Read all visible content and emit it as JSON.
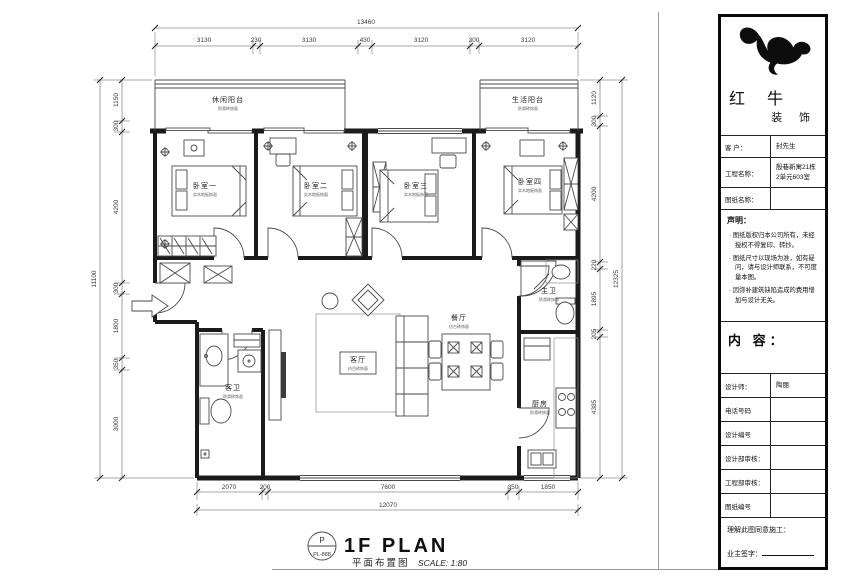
{
  "sheet": {
    "plan_title": {
      "badge_top": "P",
      "badge_bottom": "PL-888",
      "title": "1F PLAN",
      "subtitle": "平面布置图",
      "scale": "SCALE: 1:80"
    },
    "dimensions": {
      "top": {
        "total": "13460",
        "segments": [
          "3130",
          "230",
          "3130",
          "430",
          "3120",
          "300",
          "3120"
        ]
      },
      "left": {
        "total": "11100",
        "segments": [
          "1150",
          "300",
          "4200",
          "300",
          "1800",
          "350",
          "3000"
        ]
      },
      "right": {
        "total": "12325",
        "segments": [
          "1120",
          "300",
          "4200",
          "220",
          "1895",
          "205",
          "4385"
        ]
      },
      "bottom": {
        "total": "12070",
        "segments": [
          "2070",
          "200",
          "7600",
          "350",
          "1850"
        ]
      }
    },
    "rooms": {
      "balcony_left": {
        "name": "休闲阳台",
        "note": "防滑砖饰面"
      },
      "balcony_right": {
        "name": "生活阳台",
        "note": "防滑砖饰面"
      },
      "bedroom1": {
        "name": "卧室一",
        "note": "实木地板饰面"
      },
      "bedroom2": {
        "name": "卧室二",
        "note": "实木地板饰面"
      },
      "bedroom3": {
        "name": "卧室三",
        "note": "实木地板饰面"
      },
      "bedroom4": {
        "name": "卧室四",
        "note": "实木地板饰面"
      },
      "living": {
        "name": "客厅",
        "note": "仿古砖饰面"
      },
      "dining": {
        "name": "餐厅",
        "note": "仿古砖饰面"
      },
      "kitchen": {
        "name": "厨房",
        "note": "防滑砖饰面"
      },
      "bath_master": {
        "name": "主卫",
        "note": "防滑砖饰面"
      },
      "bath_guest": {
        "name": "客卫",
        "note": "防滑砖饰面"
      }
    }
  },
  "titleblock": {
    "brand": {
      "line1": "红 牛",
      "line2": "装 饰"
    },
    "client": {
      "label": "客 户：",
      "value": "封先生"
    },
    "project": {
      "label": "工程名称：",
      "value1": "殷巷新寓21栋",
      "value2": "2单元603室"
    },
    "drawing": {
      "label": "图纸名称：",
      "value": ""
    },
    "statement": {
      "title": "声明：",
      "items": [
        "· 图纸版权归本公司所有，未经授权不得复印、转抄。",
        "· 图纸尺寸以现场为准，如有疑问，请与设计师联系，不可度量本图。",
        "· 因弥补建筑缺陷造成的费用增加与设计无关。"
      ]
    },
    "content_label": "内 容：",
    "rows": [
      {
        "label": "设计师：",
        "value": "陶丽"
      },
      {
        "label": "电话号码",
        "value": ""
      },
      {
        "label": "设计编号",
        "value": ""
      },
      {
        "label": "设计部审核：",
        "value": ""
      },
      {
        "label": "工程部审核：",
        "value": ""
      },
      {
        "label": "图纸编号",
        "value": ""
      }
    ],
    "confirm": "理解此图同意施工：",
    "sign": "业主签字："
  },
  "colors": {
    "paper": "#ffffff",
    "wall": "#1b1b1b",
    "thin_line": "#4a4a4a",
    "dim_line": "#8a8a8a"
  }
}
